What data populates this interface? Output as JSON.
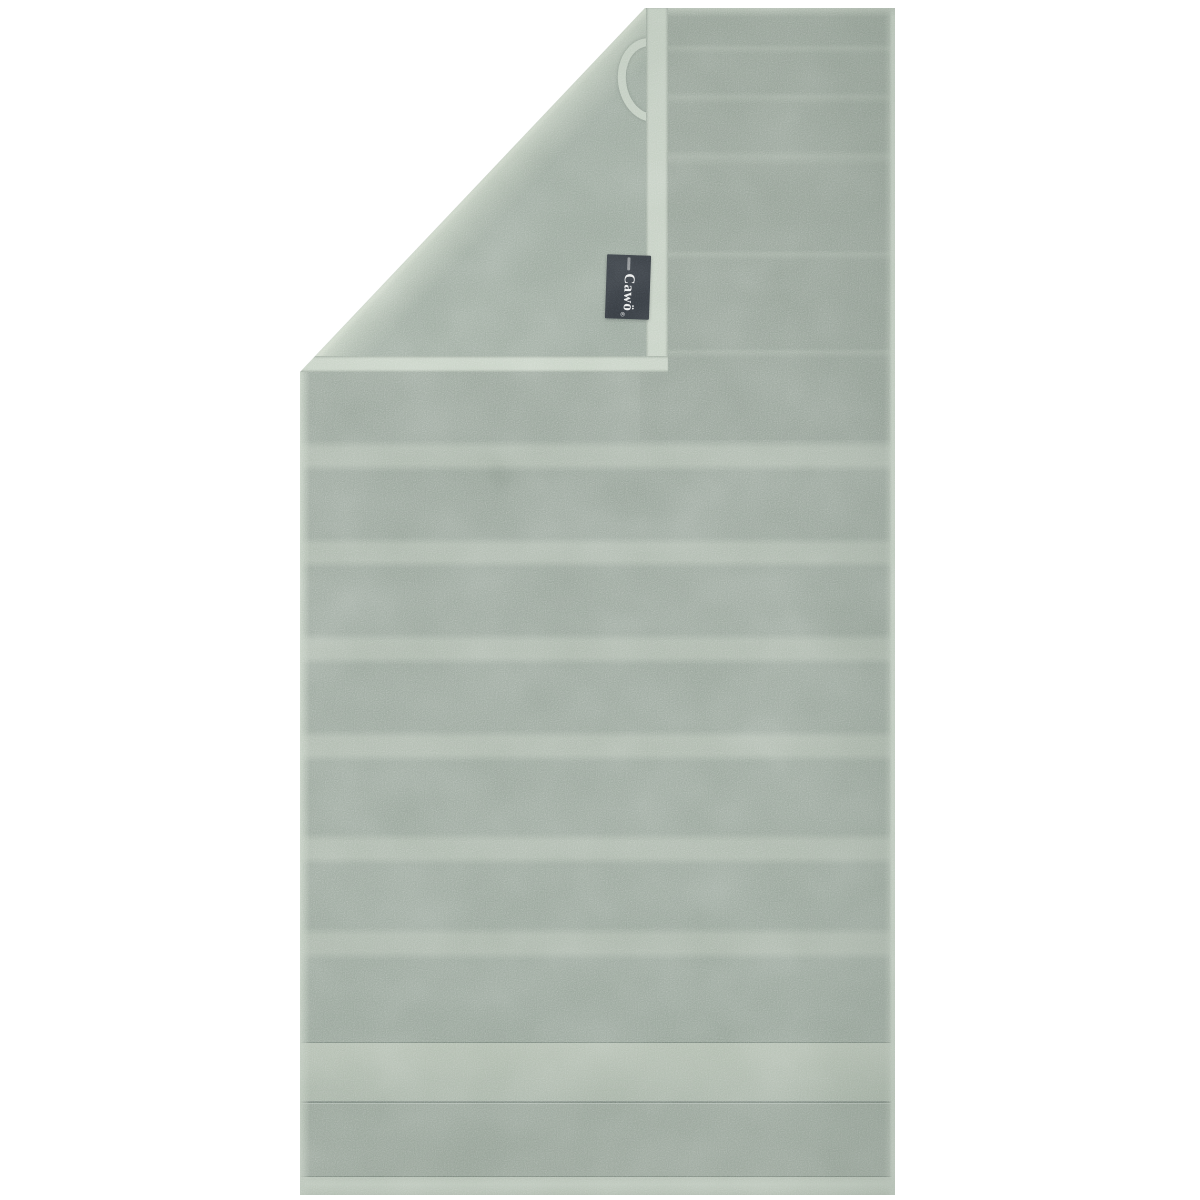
{
  "meta": {
    "type": "product-photo",
    "subject": "Sage green ribbed terry towel hanging vertically on a white background, top corner folded over to show the plush reverse side, hanging loop and sewn-in brand tag",
    "background_color": "#ffffff"
  },
  "brand_tag": {
    "label": "Cawö",
    "registered_mark": "®",
    "bg_color": "#34393f",
    "text_color": "#eceded"
  },
  "towel": {
    "palette": {
      "front": "#98a49a",
      "stripe": "#aeb9ad",
      "flap_light": "#b3bfb2",
      "flap_base": "#a2afa4",
      "hem": "#c5d0c3",
      "loop": "#c6d1c4",
      "stitch": "rgba(86,100,90,0.45)"
    },
    "front_stripes": [
      {
        "y": 432,
        "h": 32
      },
      {
        "y": 529,
        "h": 31
      },
      {
        "y": 625,
        "h": 32
      },
      {
        "y": 722,
        "h": 32
      },
      {
        "y": 825,
        "h": 32
      },
      {
        "y": 919,
        "h": 33
      }
    ],
    "top_ridges": [
      {
        "y": 36,
        "h": 10
      },
      {
        "y": 84,
        "h": 12
      },
      {
        "y": 142,
        "h": 16
      },
      {
        "y": 242,
        "h": 10
      },
      {
        "y": 340,
        "h": 10
      }
    ],
    "border_band": {
      "y": 1035,
      "h": 58
    },
    "bottom_hem": {
      "y": 1169,
      "h": 18
    }
  }
}
